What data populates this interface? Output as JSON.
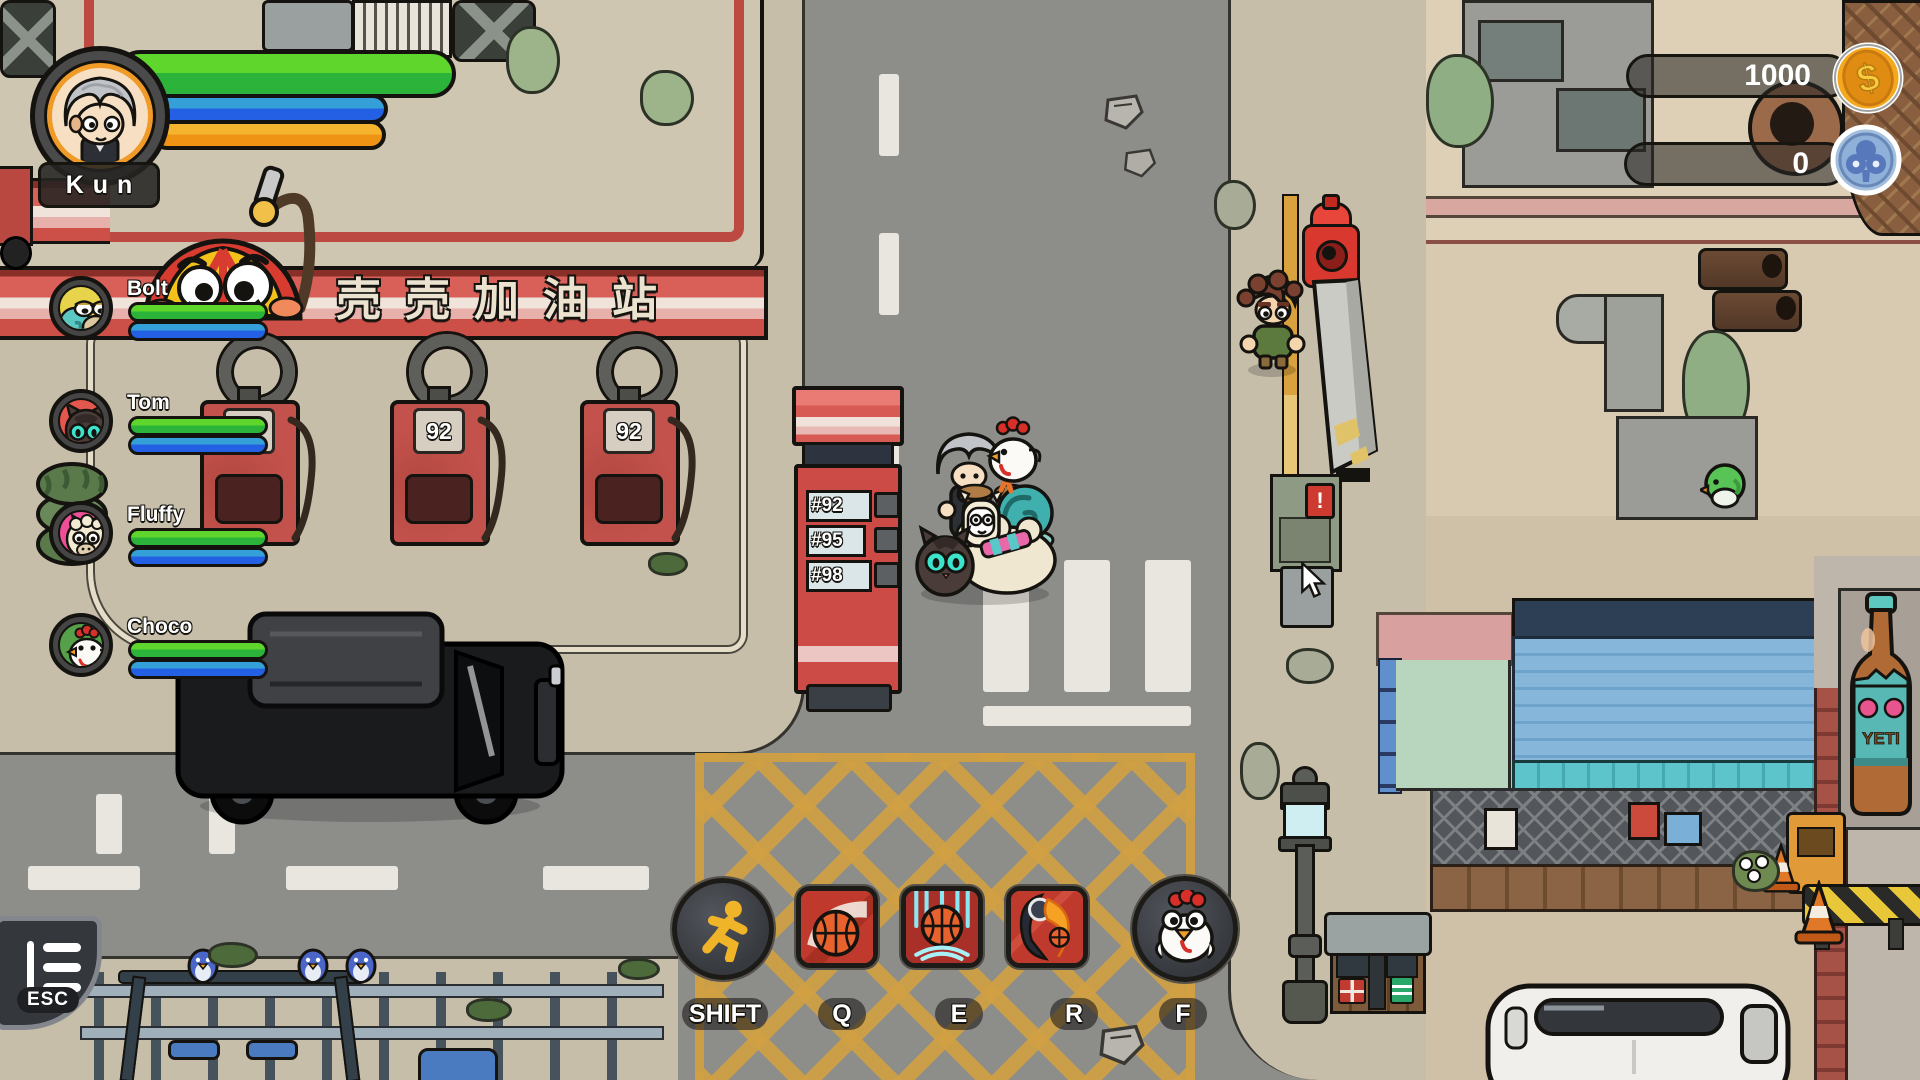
{
  "hud": {
    "player": {
      "name": "Kun"
    },
    "party": [
      {
        "name": "Bolt"
      },
      {
        "name": "Tom"
      },
      {
        "name": "Fluffy"
      },
      {
        "name": "Choco"
      }
    ],
    "currencies": [
      {
        "name": "coins",
        "value": "1000",
        "icon": "dollar-coin-icon"
      },
      {
        "name": "club-tokens",
        "value": "0",
        "icon": "club-coin-icon"
      }
    ],
    "menu_button": {
      "label": "ESC",
      "icon": "menu-icon"
    },
    "skills": [
      {
        "key": "SHIFT",
        "icon": "sprint-icon"
      },
      {
        "key": "Q",
        "icon": "basketball-shot-icon"
      },
      {
        "key": "E",
        "icon": "basketball-slam-icon"
      },
      {
        "key": "R",
        "icon": "flaming-dunk-icon"
      },
      {
        "key": "F",
        "icon": "chicken-summon-icon"
      }
    ],
    "bar_colors": {
      "health": "#45cc2b",
      "mana": "#2f8ed8",
      "stamina": "#f2a81d"
    }
  },
  "scene": {
    "gas_station": {
      "sign_text": "壳壳加油站",
      "pump_octane": "92",
      "price_board": [
        "#92",
        "#95",
        "#98"
      ]
    },
    "posters": {
      "bottle_label": "YETI"
    },
    "utility_box_mark": "!"
  }
}
